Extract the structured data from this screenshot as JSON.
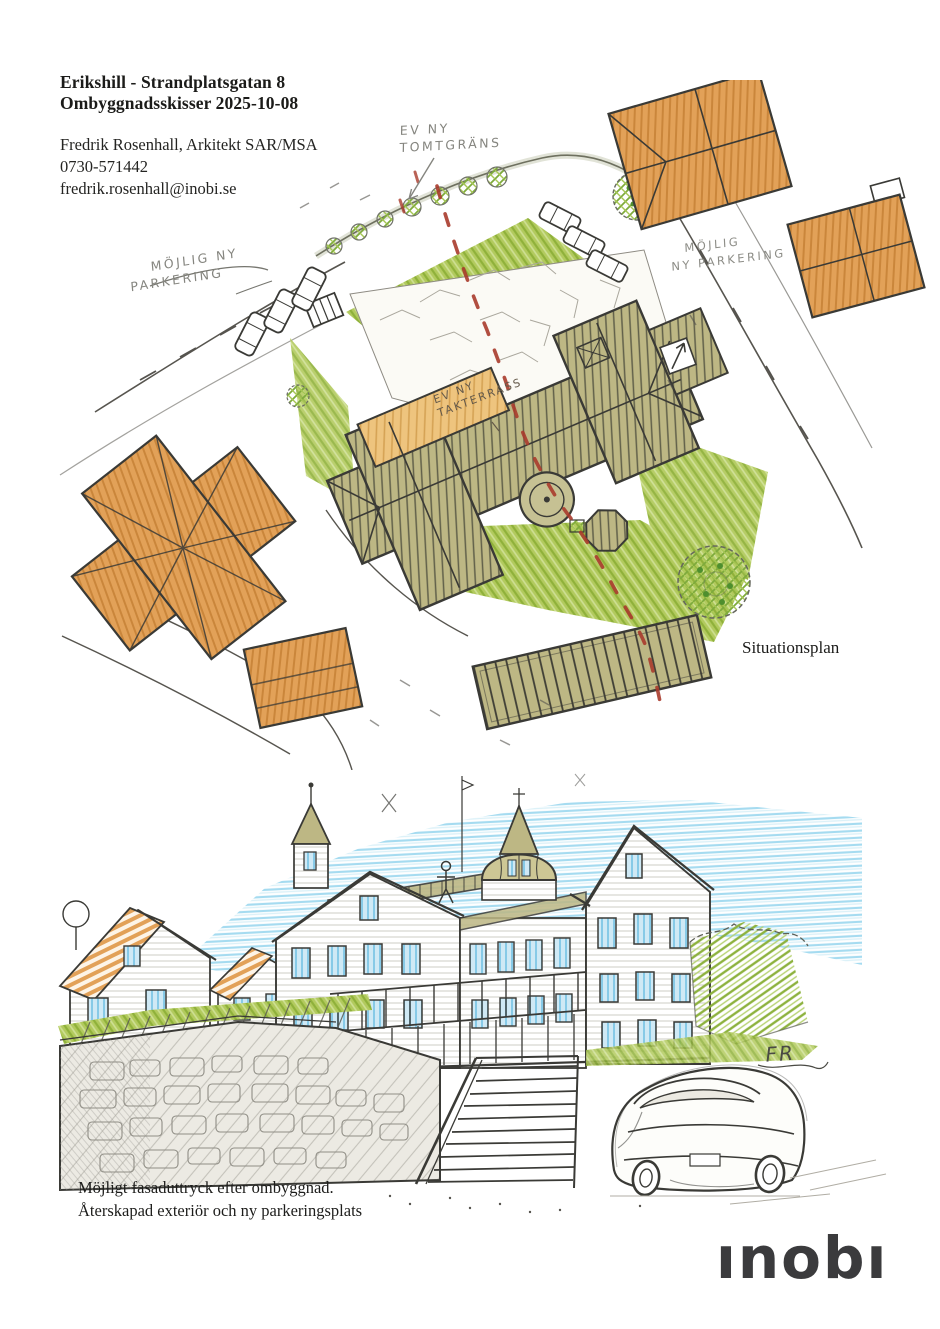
{
  "header": {
    "title_line1": "Erikshill - Strandplatsgatan 8",
    "title_line2": "Ombyggnadsskisser 2025-10-08",
    "contact_name": "Fredrik Rosenhall, Arkitekt SAR/MSA",
    "contact_phone": "0730-571442",
    "contact_email": "fredrik.rosenhall@inobi.se"
  },
  "site_plan": {
    "label": "Situationsplan",
    "annotations": {
      "tomtgrans_line1": "EV NY",
      "tomtgrans_line2": "TOMTGRÄNS",
      "parkering_left_line1": "MÖJLIG NY",
      "parkering_left_line2": "PARKERING",
      "parkering_right_line1": "MÖJLIG",
      "parkering_right_line2": "NY PARKERING",
      "takterrass_line1": "EV NY",
      "takterrass_line2": "TAKTERRASS"
    }
  },
  "facade": {
    "caption_line1": "Möjligt fasaduttryck efter ombyggnad.",
    "caption_line2": "Återskapad exteriör och ny parkeringsplats",
    "signature": "FR"
  },
  "footer": {
    "logo_text": "ınobı"
  },
  "colors": {
    "roof_orange": "#e2a158",
    "roof_olive": "#bdb784",
    "lawn_green": "#b2ca5e",
    "terrace_tan": "#eec47e",
    "boundary_red": "#a93b2c",
    "sky_blue": "#8fd2ec",
    "window_blue": "#7ac4e4",
    "door_red": "#d84b3a",
    "pencil": "#3a3a36",
    "logo_gray": "#3b3b3d"
  }
}
